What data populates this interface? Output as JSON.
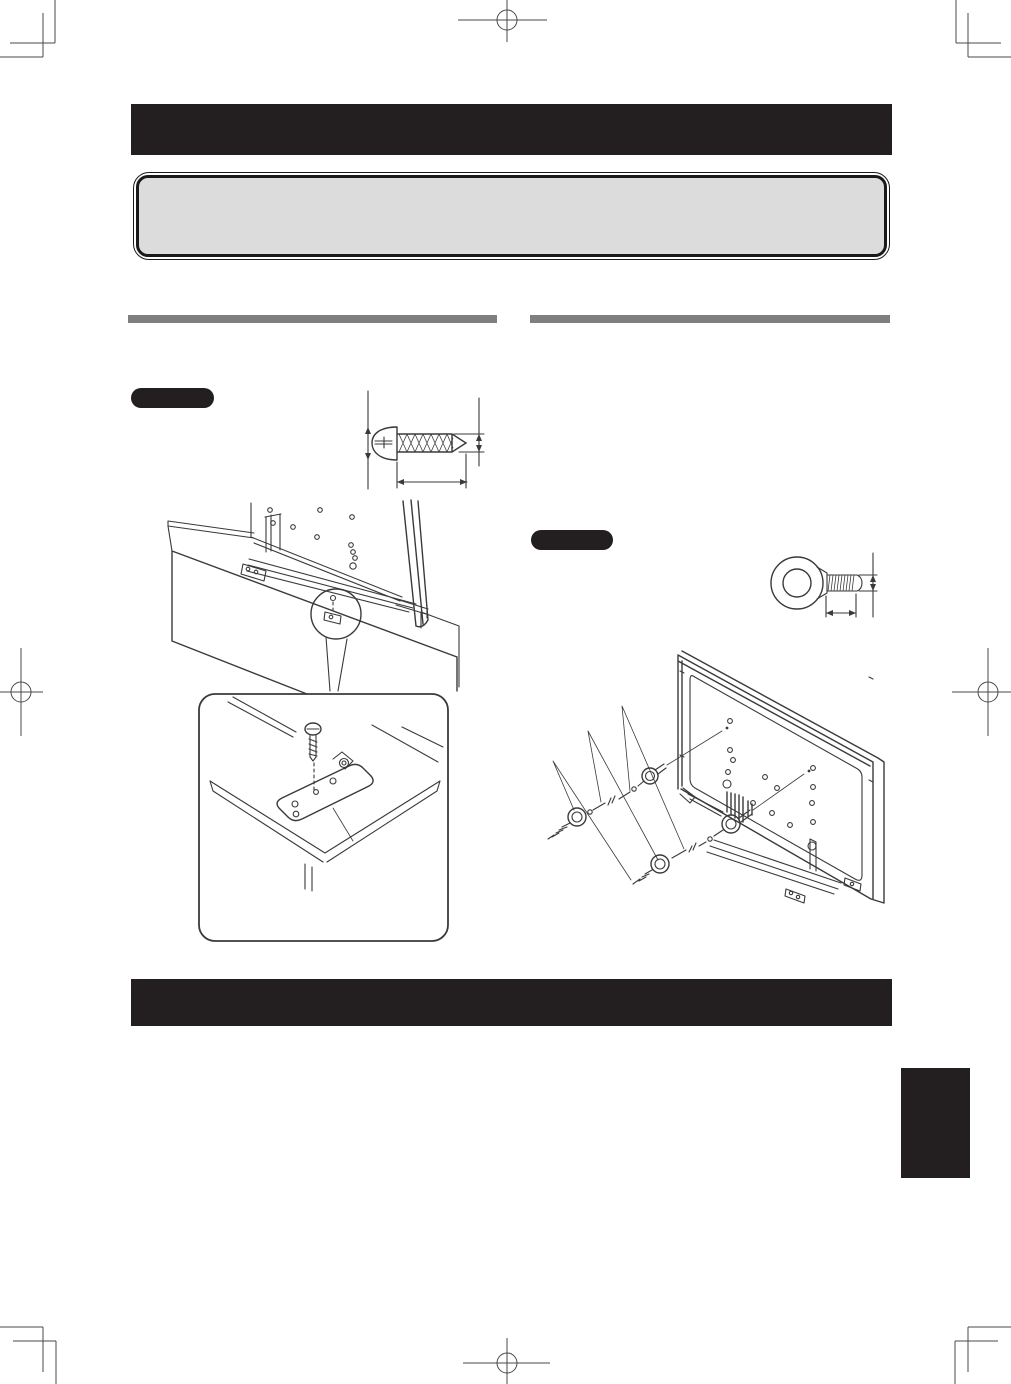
{
  "document": {
    "kind": "instruction-manual-page",
    "note": "page contains no readable text; all headings and step labels are solid filled bars"
  },
  "colors": {
    "page_bg": "#ffffff",
    "bar_black": "#231f20",
    "rule_gray": "#7f7f7f",
    "notice_fill": "#dcdcdc",
    "notice_border": "#1a1a1a",
    "line_art": "#3a3a3a"
  },
  "regions": {
    "top_title_bar": {
      "fill": "#231f20"
    },
    "notice_box": {
      "fill": "#dcdcdc",
      "border": "#1a1a1a"
    },
    "left_column_rule": {
      "fill": "#7f7f7f"
    },
    "right_column_rule": {
      "fill": "#7f7f7f"
    },
    "left_step_pill": {
      "fill": "#231f20"
    },
    "right_step_pill": {
      "fill": "#231f20"
    },
    "bottom_title_bar": {
      "fill": "#231f20"
    },
    "page_edge_index_tab": {
      "fill": "#231f20"
    }
  },
  "figures": {
    "screw_dimension_diagram": "tapping screw dimension drawing",
    "cabinet_diagram": "TV secured to cabinet rear view with magnifier callout",
    "bracket_detail": "detail callout of fixing bracket and screw on cabinet top",
    "eye_bolt_dimension_diagram": "eye bolt dimension drawing",
    "wall_tether_diagram": "TV rear tethered to wall with eye bolts strings and wall screws"
  },
  "print_marks": {
    "style": "registration crosshairs and corner crop marks"
  }
}
